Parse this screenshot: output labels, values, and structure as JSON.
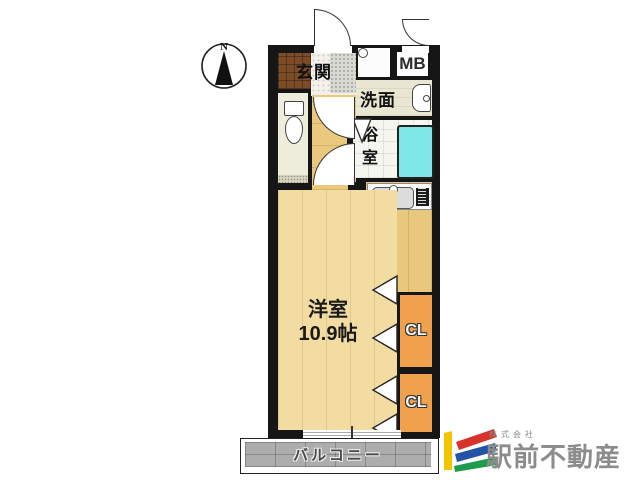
{
  "compass": {
    "north_label": "N"
  },
  "rooms": {
    "entrance": "玄関",
    "meter_box": "MB",
    "washroom": "洗面",
    "bathroom": "浴室",
    "main_room": {
      "name": "洋室",
      "size": "10.9帖"
    },
    "closet_upper": "CL",
    "closet_lower": "CL",
    "balcony": "バルコニー"
  },
  "logo": {
    "company_type": "株式会社",
    "company_name": "駅前不動産"
  },
  "palette": {
    "wall": "#161616",
    "room_floor": "#F3DCA2",
    "kitchen_floor": "#E9C87E",
    "closet": "#F1A04C",
    "bathtub": "#7EE8E8",
    "entrance_mat": "#7C4B28",
    "balcony": "#ADADAD",
    "logo_yellow": "#F2C500",
    "logo_red": "#D7332B",
    "logo_blue": "#2454A6",
    "logo_green": "#209B4E",
    "logo_text": "#8C8C8C"
  },
  "icons": {
    "compass": "circle-with-north-arrow",
    "toilet": "toilet-bowl-outline",
    "washbasin": "rounded-basin",
    "bathtub": "cyan-rect-tub",
    "kitchen_sink": "gray-sink-with-faucet",
    "stove": "black-cooktop",
    "washing_machine": "square-with-circle"
  }
}
